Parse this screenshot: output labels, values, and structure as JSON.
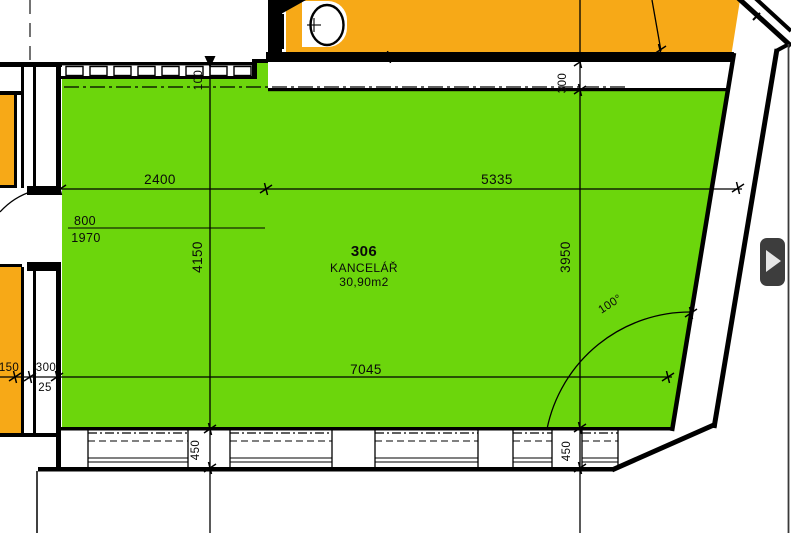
{
  "plan": {
    "room": {
      "number": "306",
      "name": "KANCELÁŘ",
      "area": "30,90m2"
    },
    "dimensions": {
      "top_left_width": "2400",
      "top_right_width": "5335",
      "bottom_width": "7045",
      "left_height": "4150",
      "right_height": "3950",
      "top_wall_thickness_left": "100",
      "top_wall_thickness_right": "300",
      "door_width": "800",
      "door_height": "1970",
      "left_wall_seg_a": "150",
      "left_wall_seg_b": "300",
      "left_wall_seg_c": "25",
      "window_pier_left": "450",
      "window_pier_right": "450",
      "door_swing_angle": "100°"
    },
    "colors": {
      "room_fill": "#6CD60C",
      "neighbor_fill": "#F7A917",
      "wall_line": "#000000",
      "panel_button": "#3D3D3D"
    }
  },
  "ui": {
    "expand_button_icon": "chevron-right"
  }
}
